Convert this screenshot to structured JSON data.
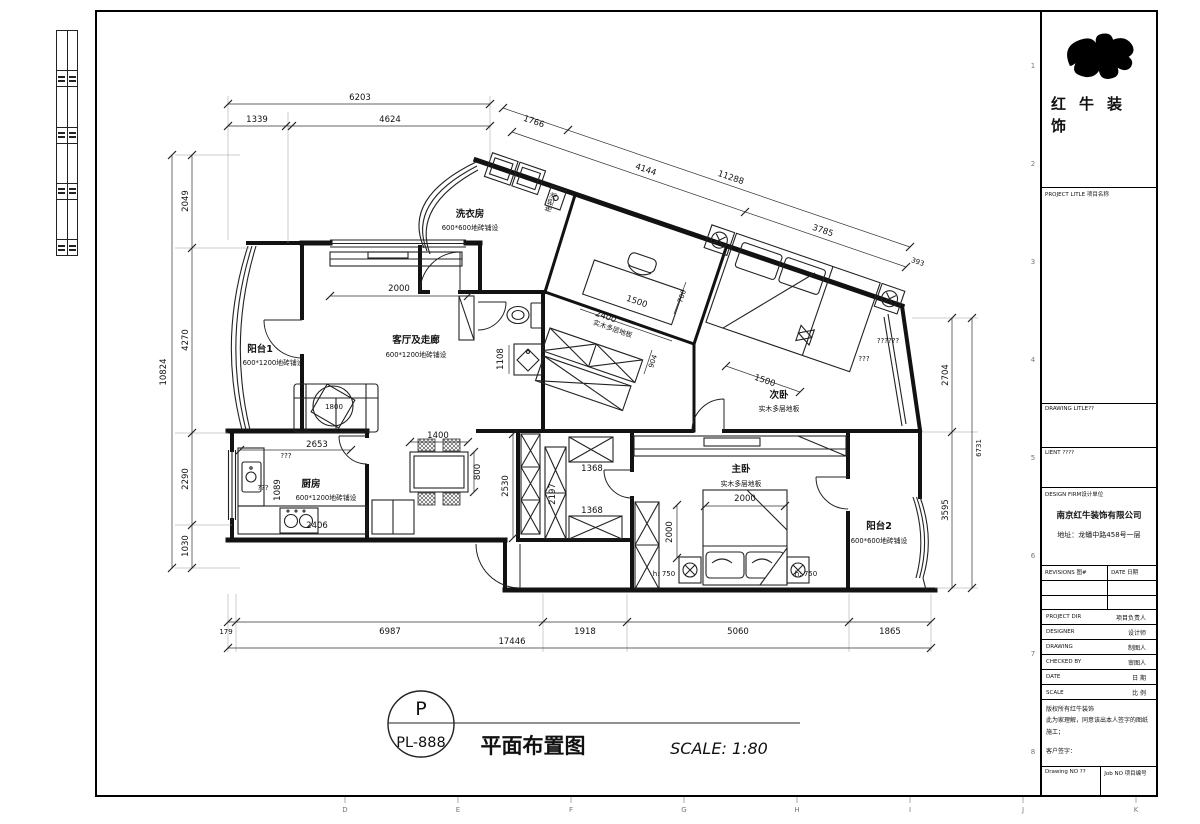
{
  "sheet": {
    "grid_letters": [
      "D",
      "E",
      "F",
      "G",
      "H",
      "I",
      "J",
      "K"
    ],
    "grid_numbers": [
      "1",
      "2",
      "3",
      "4",
      "5",
      "6",
      "7",
      "8"
    ]
  },
  "logo": {
    "line1": "红牛装",
    "line2": "饰"
  },
  "titleblock": {
    "project_title": "PROJECT LITLE 项目名称",
    "drawing_title": "DRAWING LITLE??",
    "client": "LIENT ????",
    "design_firm": "DESIGN FIRM设计单位",
    "firm_name": "南京红牛装饰有限公司",
    "firm_addr": "地址：龙蟠中路458号一层",
    "revisions": "REVISIONS 图#",
    "rev_date": "DATE 日期",
    "rows": [
      {
        "en": "PROJECT DIR",
        "cn": "项目负责人"
      },
      {
        "en": "DESIGNER",
        "cn": "设计师"
      },
      {
        "en": "DRAWING",
        "cn": "制图人"
      },
      {
        "en": "CHECKED BY",
        "cn": "审图人"
      },
      {
        "en": "DATE",
        "cn": "日 期"
      },
      {
        "en": "SCALE",
        "cn": "比 例"
      }
    ],
    "note1": "版权所有红牛装饰",
    "note2": "此为家理解，同意该出本人签字的图纸施工；",
    "note3": "客户签字：",
    "drawing_no": "Drawing NO ??",
    "job_no": "Job NO 项目编号"
  },
  "titlebar": {
    "tag": "P",
    "code": "PL-888",
    "name": "平面布置图",
    "scale": "SCALE: 1:80"
  },
  "rooms": {
    "balcony1": {
      "name": "阳台1",
      "floor": "600*1200地砖铺设"
    },
    "living": {
      "name": "客厅及走廊",
      "floor": "600*1200地砖铺设"
    },
    "laundry": {
      "name": "洗衣房",
      "floor": "600*600地砖铺设"
    },
    "kitchen": {
      "name": "厨房",
      "floor": "600*1200地砖铺设"
    },
    "bed2": {
      "name": "次卧",
      "floor": "实木多层地板"
    },
    "bed1": {
      "name": "主卧",
      "floor": "实木多层地板"
    },
    "balcony2": {
      "name": "阳台2",
      "floor": "600*600地砖铺设"
    },
    "study_floor": "实木多层地板",
    "mop_sink": "拖把池"
  },
  "dims": {
    "top_total": "6203",
    "top_segs": [
      "1339",
      "4624"
    ],
    "slant": [
      "1766",
      "4144",
      "11288",
      "3785",
      "393"
    ],
    "left_total": "10824",
    "left_segs": [
      "2049",
      "4270",
      "2290",
      "1030"
    ],
    "right_total": "6731",
    "right_segs": [
      "2704",
      "3595"
    ],
    "bottom_total": "17446",
    "bottom_segs": [
      "179",
      "6987",
      "1918",
      "5060",
      "1865"
    ],
    "living_window": "2000",
    "coffee_table": "1800",
    "dining": [
      "1400",
      "800"
    ],
    "kitchen": [
      "2653",
      "1089",
      "2406"
    ],
    "kitchen_q": [
      "???",
      "???"
    ],
    "closet": [
      "2530",
      "2197",
      "1368",
      "1368"
    ],
    "corridor": [
      "2400",
      "904",
      "1108"
    ],
    "study": [
      "1500",
      "700"
    ],
    "bed2": [
      "1500",
      "??????",
      "???"
    ],
    "bed1": [
      "2000",
      "2000"
    ],
    "nightstand_l": "h: 750",
    "nightstand_r": "h: 750"
  }
}
